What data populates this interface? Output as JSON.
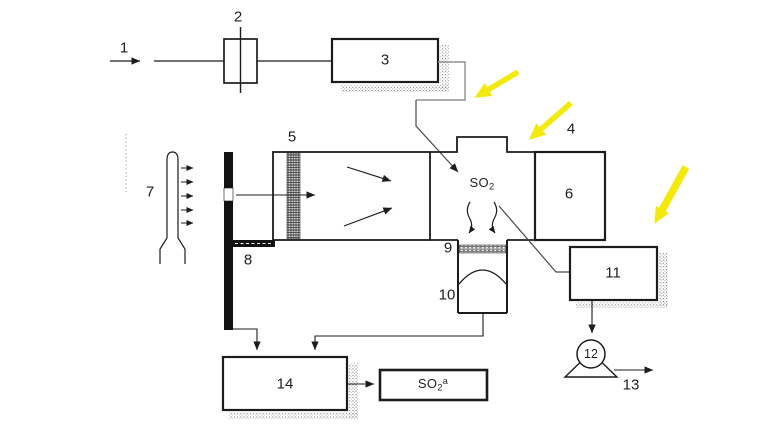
{
  "colors": {
    "accent_yellow": "#f3e90b",
    "ink": "#1c1c1c"
  },
  "labels": {
    "l1": "1",
    "l2": "2",
    "l3": "3",
    "l4": "4",
    "l5": "5",
    "l6": "6",
    "l7": "7",
    "l8": "8",
    "l9": "9",
    "l10": "10",
    "l11": "11",
    "l12": "12",
    "l13": "13",
    "l14": "14"
  },
  "species": {
    "chamber": {
      "base": "SO",
      "sub": "2"
    },
    "output": {
      "base": "SO",
      "sub": "2",
      "sup": "a"
    }
  }
}
